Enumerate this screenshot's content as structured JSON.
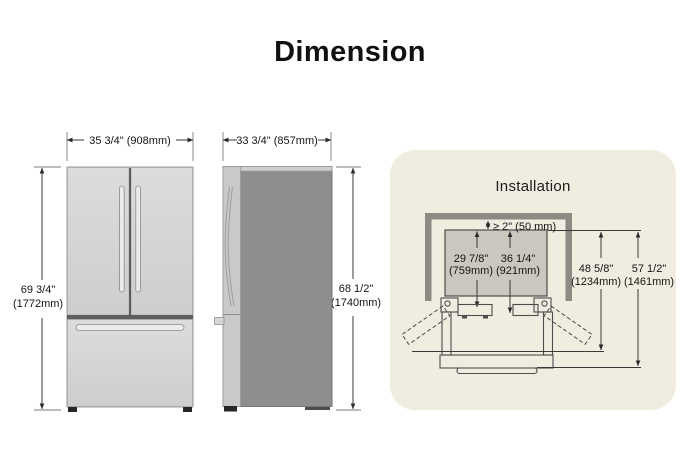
{
  "title": "Dimension",
  "front_view": {
    "width": "35 3/4\" (908mm)",
    "height_in": "69 3/4\"",
    "height_mm": "(1772mm)"
  },
  "side_view": {
    "depth": "33 3/4\" (857mm)",
    "height_in": "68 1/2\"",
    "height_mm": "(1740mm)"
  },
  "installation": {
    "title": "Installation",
    "rear_clearance": "≥ 2\" (50 mm)",
    "depth_cabinet_in": "29 7/8\"",
    "depth_cabinet_mm": "(759mm)",
    "depth_with_door_in": "36 1/4\"",
    "depth_with_door_mm": "(921mm)",
    "depth_door_open_in": "48 5/8\"",
    "depth_door_open_mm": "(1234mm)",
    "depth_total_open_in": "57 1/2\"",
    "depth_total_open_mm": "(1461mm)"
  },
  "colors": {
    "panel_bg": "#f1ece0",
    "wall": "#8b8b84",
    "topview_fill": "#cac7be",
    "fridge_light": "#d6d6d6",
    "fridge_dark": "#8e8e8e",
    "line": "#3a3a3a"
  }
}
